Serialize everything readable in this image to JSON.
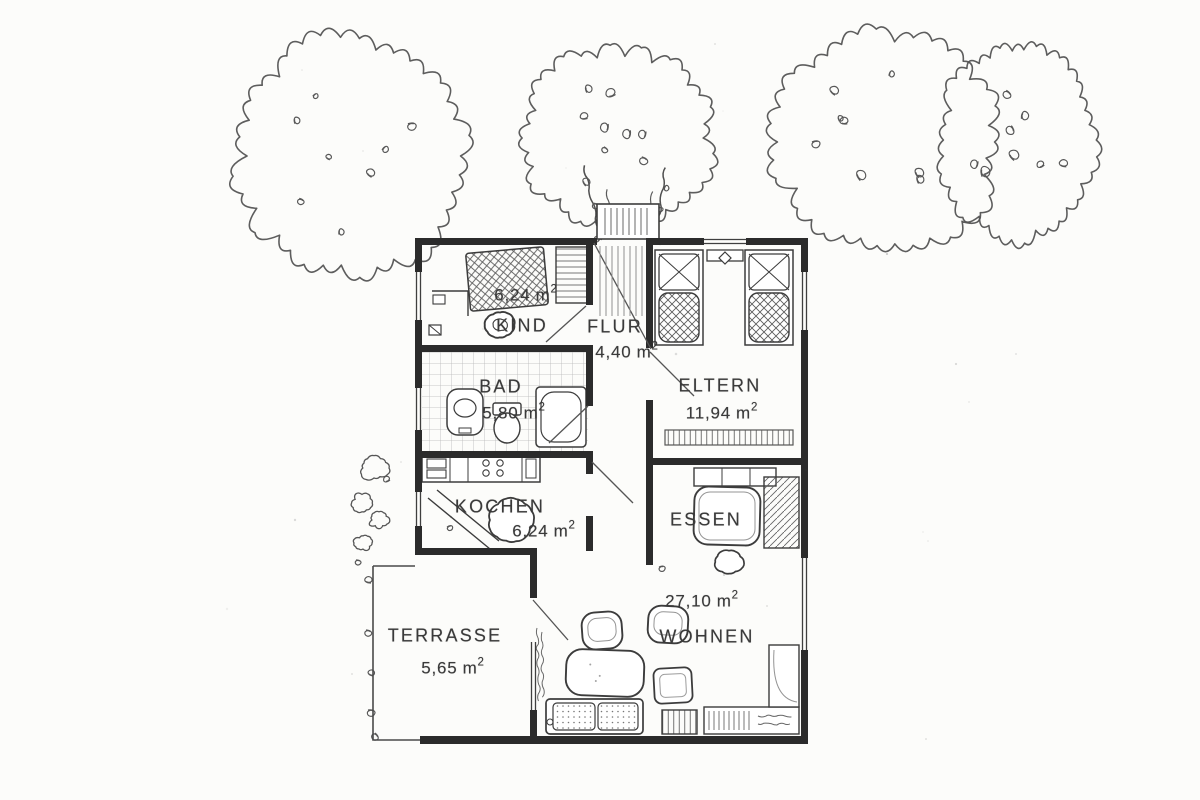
{
  "document": {
    "type": "scanned floor plan",
    "language": "de"
  },
  "colors": {
    "paper": "#fcfcfa",
    "wall_ink": "#2b2b2b",
    "sketch_ink": "#545454",
    "text_ink": "#3a3a3a"
  },
  "rooms": [
    {
      "key": "kind",
      "label": "KIND",
      "area_value": "6,24",
      "area_unit": "m",
      "area_sup": "2"
    },
    {
      "key": "flur",
      "label": "FLUR",
      "area_value": "4,40",
      "area_unit": "m",
      "area_sup": "2"
    },
    {
      "key": "bad",
      "label": "BAD",
      "area_value": "5,80",
      "area_unit": "m",
      "area_sup": "2"
    },
    {
      "key": "eltern",
      "label": "ELTERN",
      "area_value": "11,94",
      "area_unit": "m",
      "area_sup": "2"
    },
    {
      "key": "kochen",
      "label": "KOCHEN",
      "area_value": "6,24",
      "area_unit": "m",
      "area_sup": "2"
    },
    {
      "key": "essen",
      "label": "ESSEN"
    },
    {
      "key": "wohnen",
      "label": "WOHNEN",
      "area_value": "27,10",
      "area_unit": "m",
      "area_sup": "2"
    },
    {
      "key": "terrasse",
      "label": "TERRASSE",
      "area_value": "5,65",
      "area_unit": "m",
      "area_sup": "2"
    }
  ]
}
